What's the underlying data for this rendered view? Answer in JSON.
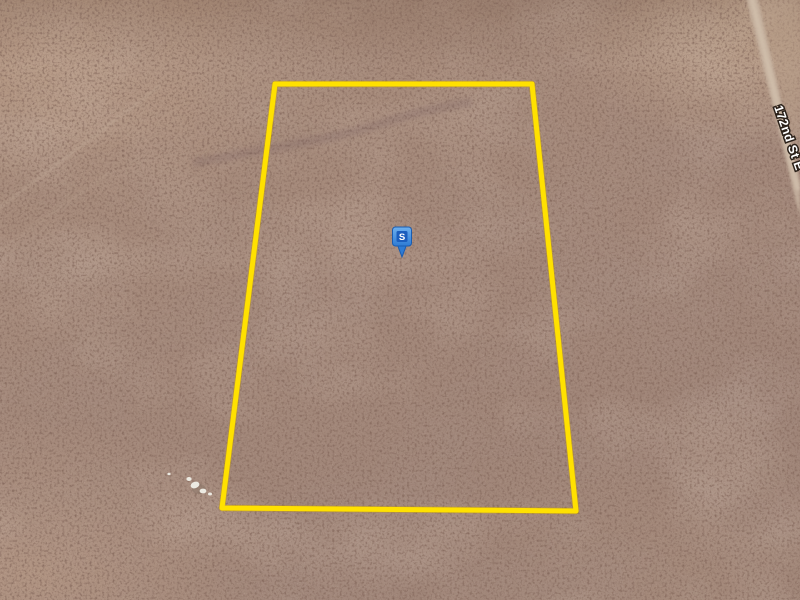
{
  "map": {
    "road_label": "172nd St E",
    "road_label_transform": "translate(774,107) rotate(71)",
    "marker": {
      "label": "S",
      "transform": "translate(402,257)",
      "fill": "#2E7BD4",
      "inner_fill": "#1B5DBD",
      "label_color": "#FFFFFF"
    },
    "parcel": {
      "points": "275,84 532,84 576,511 222,508",
      "outline_color": "#FFE100",
      "outline_undercolor": "#C79B00"
    },
    "terrain": {
      "base_color": "#A4897B",
      "speckle_color": "#52382C",
      "road_color": "#C7B4A1",
      "rock_color": "#ECEAE2"
    }
  }
}
